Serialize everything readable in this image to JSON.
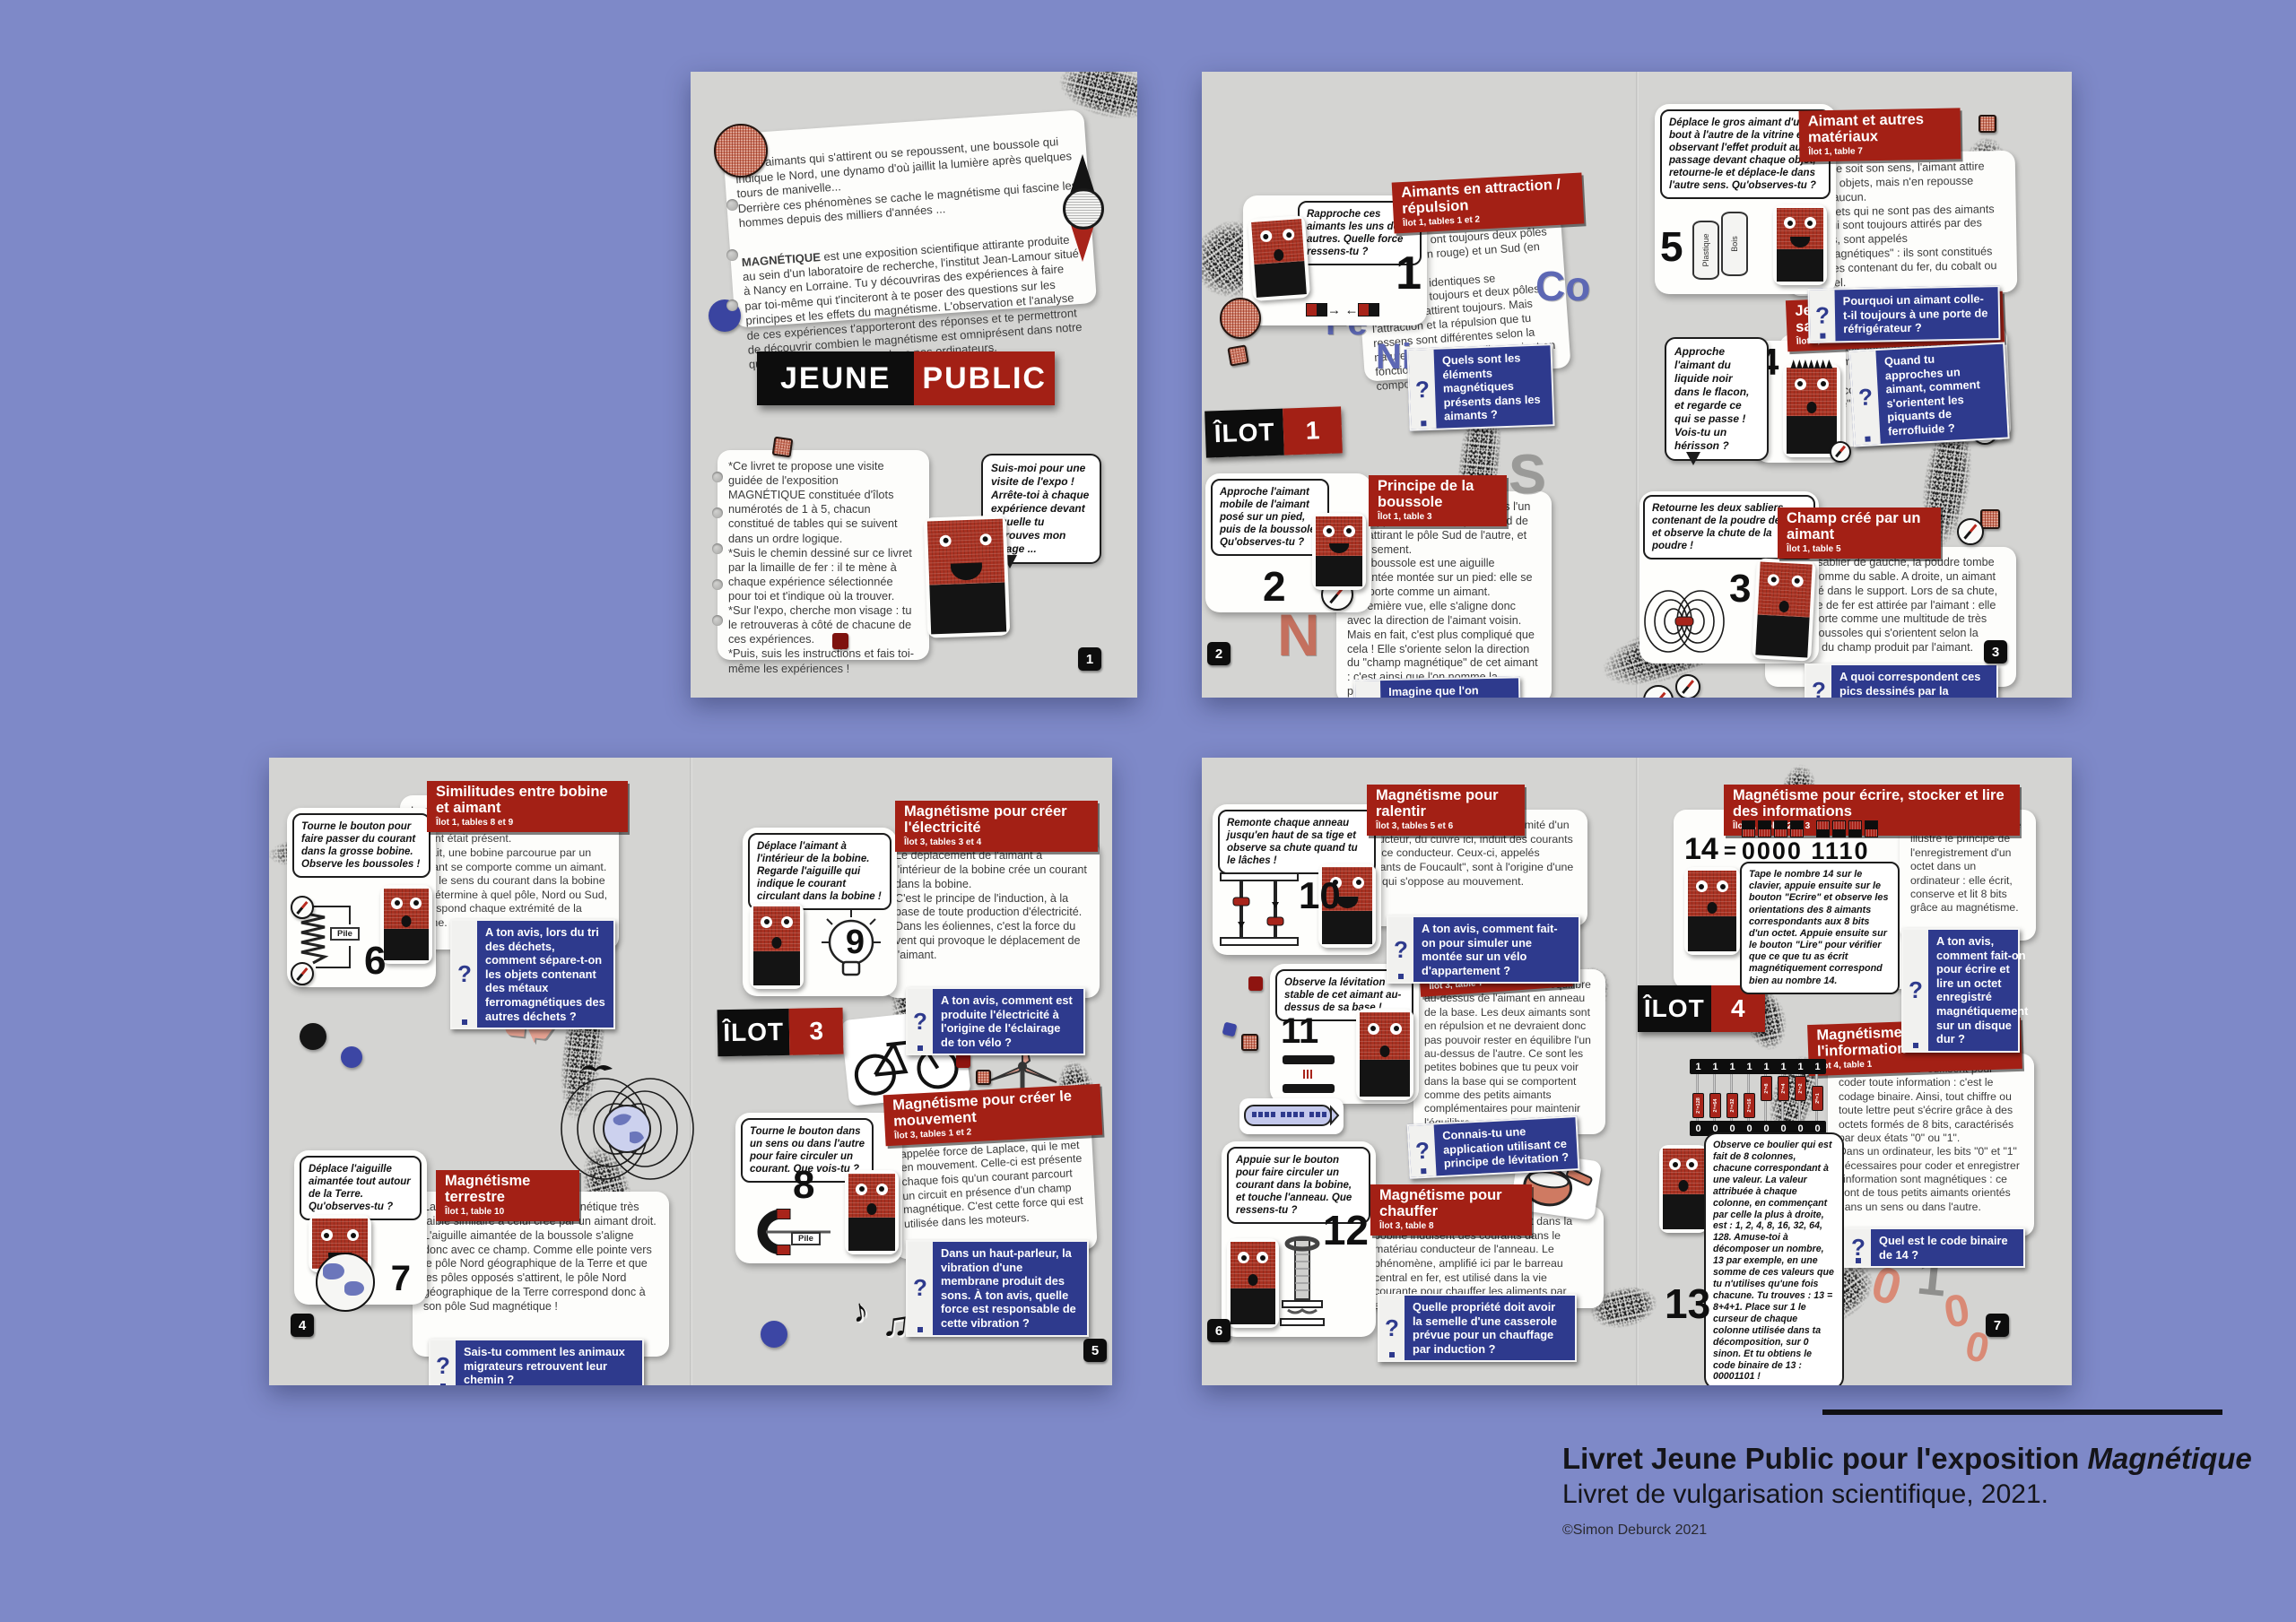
{
  "ui": {
    "qmark": "?",
    "one": "1",
    "zero": "0",
    "pile": "Pile",
    "recycle": "♻",
    "notes": [
      "♪",
      "♫",
      "♩",
      "♪"
    ]
  },
  "caption": {
    "line1a": "Livret Jeune Public pour l'exposition ",
    "line1b": "Magnétique",
    "line2": "Livret de vulgarisation scientifique, 2021.",
    "credit": "©Simon Deburck 2021"
  },
  "cover": {
    "intro1": "Deux aimants qui s'attirent ou se repoussent, une boussole qui indique le Nord, une dynamo d'où jaillit la lumière après quelques tours de manivelle...\nDerrière ces phénomènes se cache le magnétisme qui fascine les hommes depuis des milliers d'années ...",
    "intro2_lead": "MAGNÉTIQUE",
    "intro2_rest": " est une exposition scientifique attirante produite au sein d'un laboratoire de recherche, l'institut Jean-Lamour situé à Nancy en Lorraine. Tu y découvriras des expériences à faire par toi-même qui t'inciteront à te poser des questions sur les principes et les effets du magnétisme. L'observation et l'analyse de ces expériences t'apporteront des réponses et te permettront de découvrir combien le magnétisme est omniprésent dans notre quotidien, et en particulier dans nos ordinateurs.",
    "title_left": "JEUNE",
    "title_right": "PUBLIC",
    "guide": "*Ce livret te propose une visite guidée de l'exposition MAGNÉTIQUE constituée d'îlots numérotés de 1 à 5, chacun constitué de tables qui se suivent dans un ordre logique.\n*Suis le chemin dessiné sur ce livret par la limaille de fer : il te mène à chaque expérience sélectionnée pour toi et t'indique où la trouver.\n*Sur l'expo, cherche mon visage : tu le retrouveras à côté de chacune de ces expériences.\n*Puis, suis les instructions et fais toi-même les expériences !",
    "bubble": "Suis-moi pour une visite de l'expo ! Arrête-toi à chaque expérience devant laquelle tu retrouves mon visage ...",
    "page": "1"
  },
  "s1": {
    "ilot": {
      "label": "ÎLOT",
      "num": "1"
    },
    "pages": {
      "left": "2",
      "right": "3"
    },
    "letters": {
      "fe": "Fe",
      "ni": "Ni",
      "co": "Co",
      "n": "N",
      "s": "S"
    },
    "attraction": {
      "title": "Aimants en attraction / répulsion",
      "loc": "Îlot 1, tables 1 et 2",
      "bubble": "Rapproche ces aimants les uns des autres. Quelle force ressens-tu ?",
      "num": "1",
      "body": "Les aimants ont toujours deux pôles : un Nord (en rouge) et un Sud (en noir).\nDeux pôles identiques se repoussent toujours et deux pôles opposés s'attirent toujours. Mais l'attraction et la répulsion que tu ressens sont différentes selon la nature des aimants : elles varient en fonction des matériaux qui les composent.",
      "question": "Quels sont les éléments magnétiques présents dans les aimants ?"
    },
    "boussole": {
      "title": "Principe de la boussole",
      "loc": "Îlot 1, table 3",
      "bubble": "Approche l'aimant mobile de l'aimant posé sur un pied, puis de la boussole. Qu'observes-tu ?",
      "num": "2",
      "body": "Deux aimants s'alignent toujours l'un par rapport à l'autre, le pôle Nord de l'un attirant le pôle Sud de l'autre, et inversement.\nUne boussole est une aiguille aimantée montée sur un pied: elle se comporte comme un aimant.\nA première vue, elle s'aligne donc avec la direction de l'aimant voisin. Mais en fait, c'est plus compliqué que cela ! Elle s'oriente selon la direction du \"champ magnétique\" de cet aimant : c'est ainsi que l'on nomme la propriété créée par un aimant tout autour de lui.",
      "question": "Imagine que l'on place une forêt de toutes petites boussoles autour d'un aimant. A ton avis, que va-t-il se passer ?"
    },
    "materiaux": {
      "title": "Aimant et autres matériaux",
      "loc": "Îlot 1, table 7",
      "bubble": "Déplace le gros aimant d'un bout à l'autre de la vitrine en observant l'effet produit au passage devant chaque objet, retourne-le et déplace-le dans l'autre sens. Qu'observes-tu ?",
      "num": "5",
      "lab1": "Plastique",
      "lab2": "Bois",
      "body": "Quel que soit son sens, l'aimant attire certains objets, mais n'en repousse jamais aucun.\nCes objets qui ne sont pas des aimants mais qui sont toujours attirés par des aimants, sont appelés \"ferromagnétiques\" : ils sont constitués d'alliages contenant du fer, du cobalt ou du nickel.",
      "question": "Pourquoi un aimant colle-t-il toujours à une porte de réfrigérateur ?"
    },
    "herisson": {
      "title": "Jeux du hérisson et du sapin de Noël",
      "loc": "Îlot 1, table 6",
      "bubble": "Approche l'aimant du liquide noir dans le flacon, et regarde ce qui se passe ! Vois-tu un hérisson ?",
      "num": "4",
      "body": "Le liquide noir contient de très fines particules magnétiques en suspension, dispersées régulièrement dans une solution incolore. Il porte le nom de \"ferrofluide\".",
      "question": "Quand tu approches un aimant, comment s'orientent les piquants de ferrofluide ?"
    },
    "champ": {
      "title": "Champ créé par un aimant",
      "loc": "Îlot 1, table 5",
      "bubble": "Retourne les deux sabliers contenant de la poudre de fer et observe la chute de la poudre !",
      "num": "3",
      "body": "Dans le sablier de gauche, la poudre tombe en tas, comme du sable. A droite, un aimant est caché dans le support. Lors de sa chute, la poudre de fer est attirée par l'aimant : elle se comporte comme une multitude de très petites boussoles qui s'orientent selon la direction du champ produit par l'aimant.",
      "question": "A quoi correspondent ces pics dessinés par la poudre de fer ?"
    }
  },
  "s2": {
    "ilot": {
      "label": "ÎLOT",
      "num": "3"
    },
    "pages": {
      "left": "4",
      "right": "5"
    },
    "bobine": {
      "title": "Similitudes entre bobine et aimant",
      "loc": "Îlot 1, tables 8 et 9",
      "bubble": "Tourne le bouton pour faire passer du courant dans la grosse bobine. Observe les boussoles !",
      "num": "6",
      "body": "Les aiguilles des boussoles s'alignent lorsque le courant circule, comme si un aimant était présent.\nEn fait, une bobine parcourue par un courant se comporte comme un aimant. C'est le sens du courant dans la bobine qui détermine à quel pôle, Nord ou Sud, correspond chaque extrémité de la bobine.",
      "question": "A ton avis, lors du tri des déchets, comment sépare-t-on les objets contenant des métaux ferromagnétiques des autres déchets ?"
    },
    "terrestre": {
      "title": "Magnétisme terrestre",
      "loc": "Îlot 1, table 10",
      "bubble": "Déplace l'aiguille aimantée tout autour de la Terre. Qu'observes-tu ?",
      "num": "7",
      "body": "La Terre produit un champ magnétique très faible similaire à celui créé par un aimant droit. L'aiguille aimantée de la boussole s'aligne donc avec ce champ. Comme elle pointe vers le pôle Nord géographique de la Terre et que les pôles opposés s'attirent, le pôle Nord géographique de la Terre correspond donc à son pôle Sud magnétique !",
      "question": "Sais-tu comment les animaux migrateurs retrouvent leur chemin ?"
    },
    "electricite": {
      "title": "Magnétisme pour créer l'électricité",
      "loc": "Îlot 3, tables 3 et 4",
      "bubble": "Déplace l'aimant à l'intérieur de la bobine. Regarde l'aiguille qui indique le courant circulant dans la bobine !",
      "num": "9",
      "body": "Le déplacement de l'aimant à l'intérieur de la bobine crée un courant dans la bobine.\nC'est le principe de l'induction, à la base de toute production d'électricité.\nDans les éoliennes, c'est la force du vent qui provoque le déplacement de l'aimant.",
      "question": "A ton avis, comment est produite l'électricité à l'origine de l'éclairage de ton vélo ?"
    },
    "mouvement": {
      "title": "Magnétisme pour créer le mouvement",
      "loc": "Îlot 3, tables 1 et 2",
      "bubble": "Tourne le bouton dans un sens ou dans l'autre pour faire circuler un courant. Que vois-tu ?",
      "num": "8",
      "body": "Le barreau est soumis à une force, appelée force de Laplace, qui le met en mouvement. Celle-ci est présente chaque fois qu'un courant parcourt un circuit en présence d'un champ magnétique. C'est cette force qui est utilisée dans les moteurs.",
      "question": "Dans un haut-parleur, la vibration d'une membrane produit des sons. À ton avis, quelle force est responsable de cette vibration ?"
    }
  },
  "s3": {
    "ilot": {
      "label": "ÎLOT",
      "num": "4"
    },
    "pages": {
      "left": "6",
      "right": "7"
    },
    "digits": [
      "0",
      "1",
      "0",
      "0"
    ],
    "ralentir": {
      "title": "Magnétisme pour ralentir",
      "loc": "Îlot 3, tables 5 et 6",
      "bubble": "Remonte chaque anneau jusqu'en haut de sa tige et observe sa chute quand tu le lâches !",
      "num": "10",
      "body": "Le mouvement d'un aimant à proximité d'un conducteur, du cuivre ici, induit des courants dans ce conducteur. Ceux-ci, appelés \"courants de Foucault\", sont à l'origine d'une force qui s'oppose au mouvement.",
      "question": "A ton avis, comment fait-on pour simuler une montée sur un vélo d'appartement ?"
    },
    "leviter": {
      "title": "Magnétisme pour léviter",
      "loc": "Îlot 3, table 7",
      "bubble": "Observe la lévitation stable de cet aimant au-dessus de sa base !",
      "num": "11",
      "body": "L'aimant supérieur est en équilibre au-dessus de l'aimant en anneau de la base. Les deux aimants sont en répulsion et ne devraient donc pas pouvoir rester en équilibre l'un au-dessus de l'autre. Ce sont les petites bobines que tu peux voir dans la base qui se comportent comme des petits aimants complémentaires pour maintenir l'équilibre.",
      "question": "Connais-tu une application utilisant ce principe de lévitation ?"
    },
    "chauffer": {
      "title": "Magnétisme pour chauffer",
      "loc": "Îlot 3, table 8",
      "bubble": "Appuie sur le bouton pour faire circuler un courant dans la bobine, et touche l'anneau. Que ressens-tu ?",
      "num": "12",
      "body": "Les courants alternatifs circulant dans la bobine induisent des courants dans le matériau conducteur de l'anneau. Le phénomène, amplifié ici par le barreau central en fer, est utilisé dans la vie courante pour chauffer les aliments par exemple.",
      "question": "Quelle propriété doit avoir la semelle d'une casserole prévue pour un chauffage par induction ?"
    },
    "ecrire": {
      "title": "Magnétisme pour écrire, stocker et lire des informations",
      "loc": "Îlot 4, tables 2 et 3",
      "bubble": "Tape le nombre 14 sur le clavier, appuie ensuite sur le bouton \"Ecrire\" et observe les orientations des 8 aimants correspondants aux 8 bits d'un octet. Appuie ensuite sur le bouton \"Lire\" pour vérifier que ce que tu as écrit magnétiquement correspond bien au nombre 14.",
      "display": {
        "value": "14",
        "eq": "=",
        "bits": "0000 1110"
      },
      "body": "Cette grosse maquette illustre le principe de l'enregistrement d'un octet dans un ordinateur : elle écrit, conserve et lit 8 bits grâce au magnétisme.",
      "question": "A ton avis, comment fait-on pour écrire et lire un octet enregistré magnétiquement sur un disque dur ?"
    },
    "coder": {
      "title": "Magnétisme pour coder l'information",
      "loc": "Îlot 4, table 1",
      "bubble": "Observe ce boulier qui est fait de 8 colonnes, chacune correspondant à une valeur. La valeur attribuée à chaque colonne, en commençant par celle la plus à droite, est : 1, 2, 4, 8, 16, 32, 64, 128. Amuse-toi à décomposer un nombre, 13 par exemple, en une somme de ces valeurs que tu n'utilises qu'une fois chacune. Tu trouves : 13 = 8+4+1. Place sur 1 le curseur de chaque colonne utilisée dans ta décomposition, sur 0 sinon. Et tu obtiens le code binaire de 13 : 00001101 !",
      "num": "13",
      "labels": [
        "2⁷=128",
        "2⁶=64",
        "2⁵=32",
        "2⁴=16",
        "2³=8",
        "2²=4",
        "2¹=2",
        "2⁰=1"
      ],
      "body": "Des \"0\" et des \"1\" suffisent pour coder toute information : c'est le codage binaire. Ainsi, tout chiffre ou toute lettre peut s'écrire grâce à des octets formés de 8 bits, caractérisés par deux états \"0\" ou \"1\".\nDans un ordinateur, les bits \"0\" et \"1\" nécessaires pour coder et enregistrer l'information sont magnétiques : ce sont de tous petits aimants orientés dans un sens ou dans l'autre.",
      "question": "Quel est le code binaire de 14 ?"
    }
  }
}
